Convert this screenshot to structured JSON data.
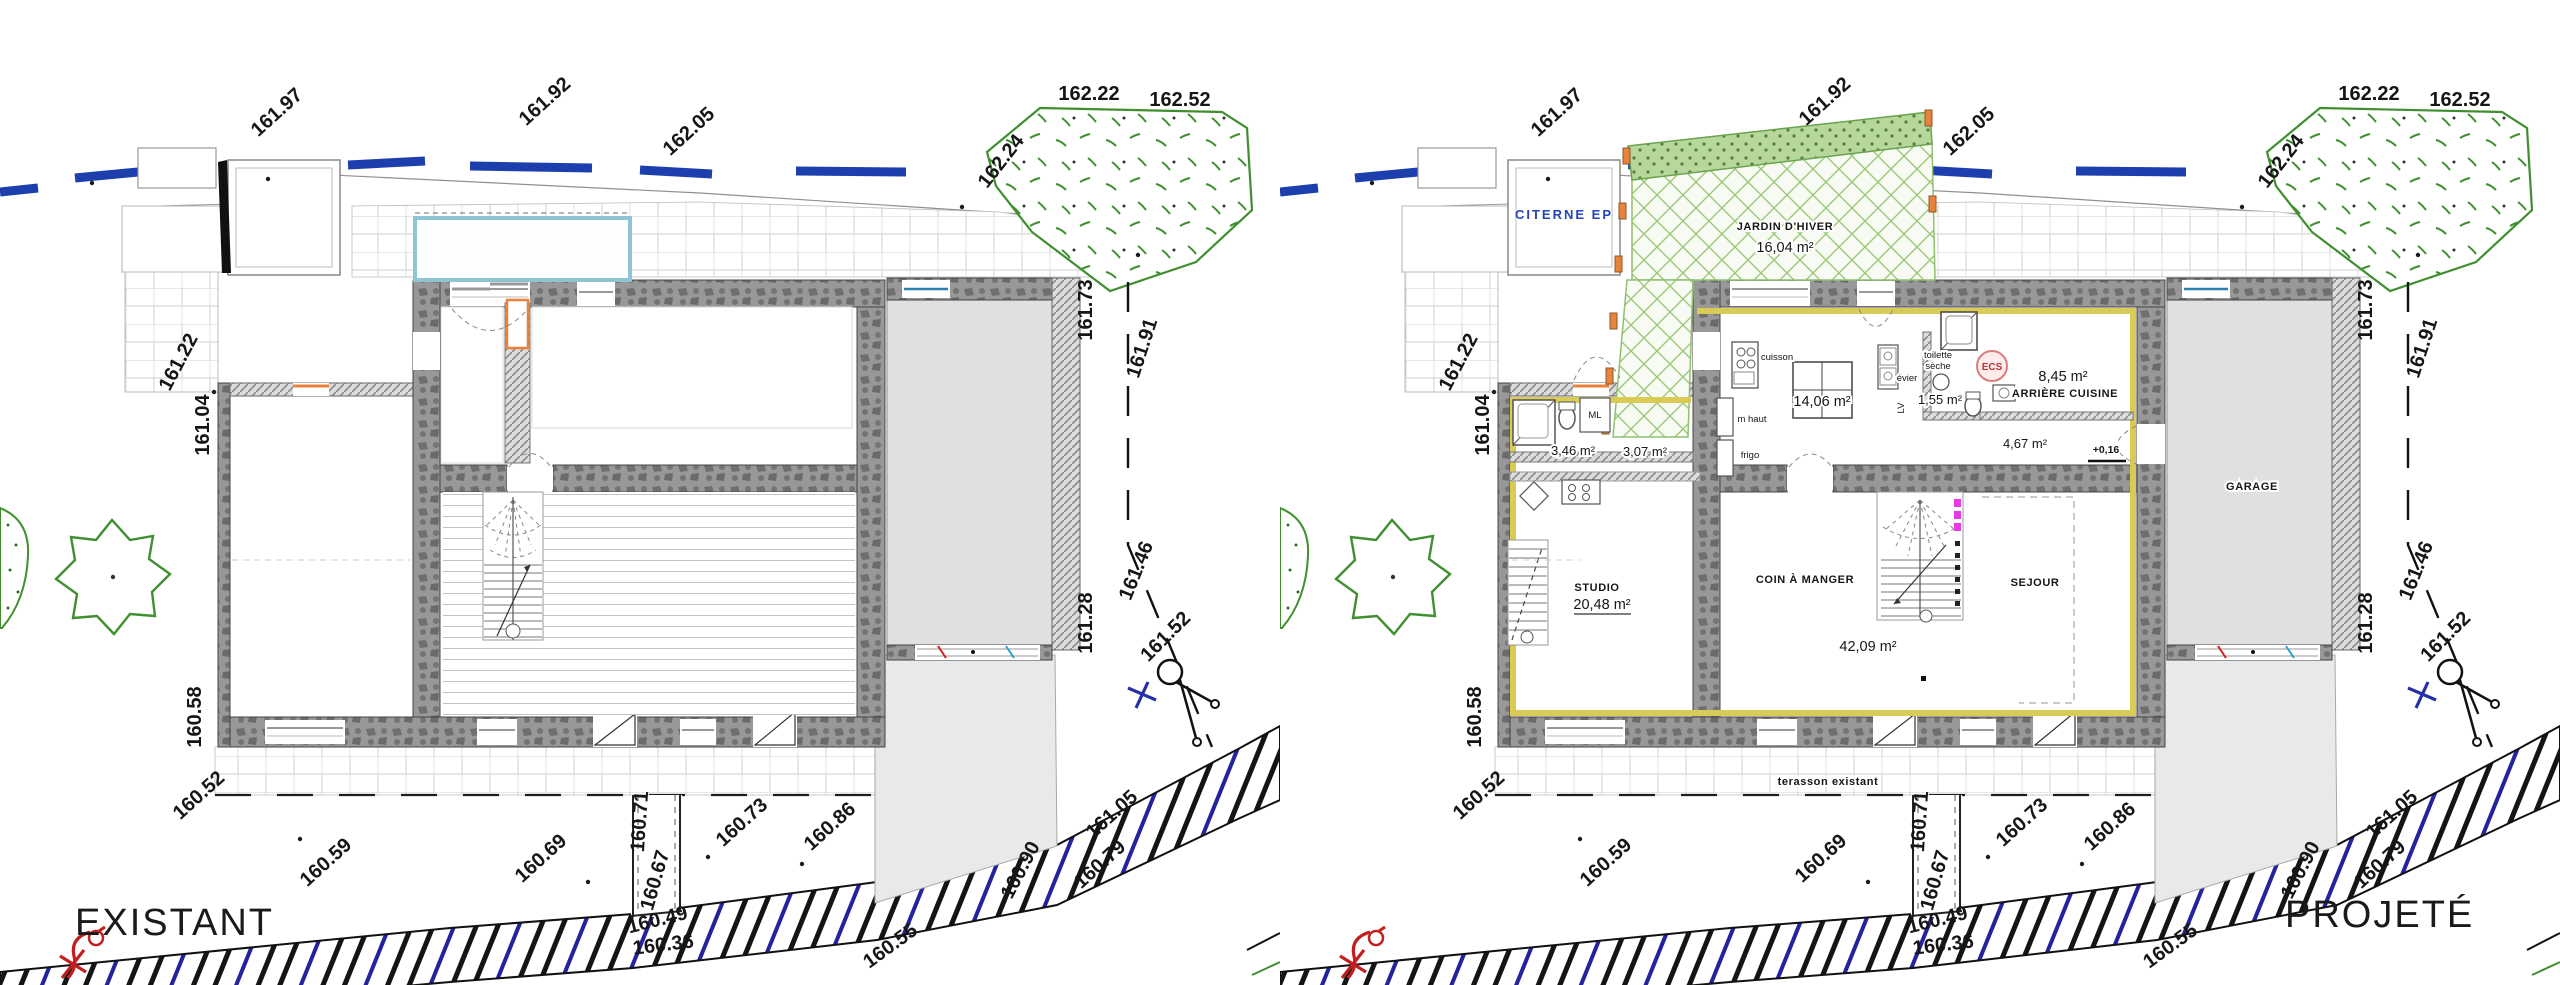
{
  "plans": {
    "left_title": "EXISTANT",
    "right_title": "PROJETÉ"
  },
  "site": {
    "elevations": [
      "161.97",
      "161.92",
      "162.05",
      "162.24",
      "162.22",
      "162.52",
      "161.73",
      "161.91",
      "161.46",
      "161.28",
      "161.52",
      "161.22",
      "161.04",
      "160.58",
      "160.52",
      "160.59",
      "160.69",
      "160.71",
      "160.67",
      "160.49",
      "160.36",
      "160.73",
      "160.86",
      "160.55",
      "160.90",
      "161.05",
      "160.79"
    ]
  },
  "rooms": {
    "citerne": "CITERNE  EP",
    "jardin_name": "JARDIN D'HIVER",
    "jardin_area": "16,04 m²",
    "cuisson": "cuisson",
    "kitchen_area": "14,06 m²",
    "m_haut": "m haut",
    "frigo": "frigo",
    "evier": "évier",
    "lv": "LV",
    "ml": "ML",
    "toilette_1": "toilette",
    "toilette_2": "sèche",
    "toilette_area": "1,55 m²",
    "ecs": "ECS",
    "arriere_area": "8,45 m²",
    "arriere_name": "ARRIÈRE CUISINE",
    "cellier_area": "4,67 m²",
    "level": "+0,16",
    "garage": "GARAGE",
    "bath_area": "3,46 m²",
    "entry_area": "3,07 m²",
    "studio_name": "STUDIO",
    "studio_area": "20,48 m²",
    "coin_name": "COIN À MANGER",
    "sejour_name": "SEJOUR",
    "living_area": "42,09 m²",
    "terrace": "terasson existant"
  },
  "colors": {
    "contour_blue": "#1d3fae",
    "vegetation_green": "#3f8f2f",
    "winter_garden_green": "#9cc878",
    "insulation_yellow": "#d9cb55",
    "joinery_orange": "#e8823c",
    "stair_magenta": "#e53ae5",
    "citerne_blue": "#2244bb",
    "ecs_pink": "#d97d7d"
  }
}
